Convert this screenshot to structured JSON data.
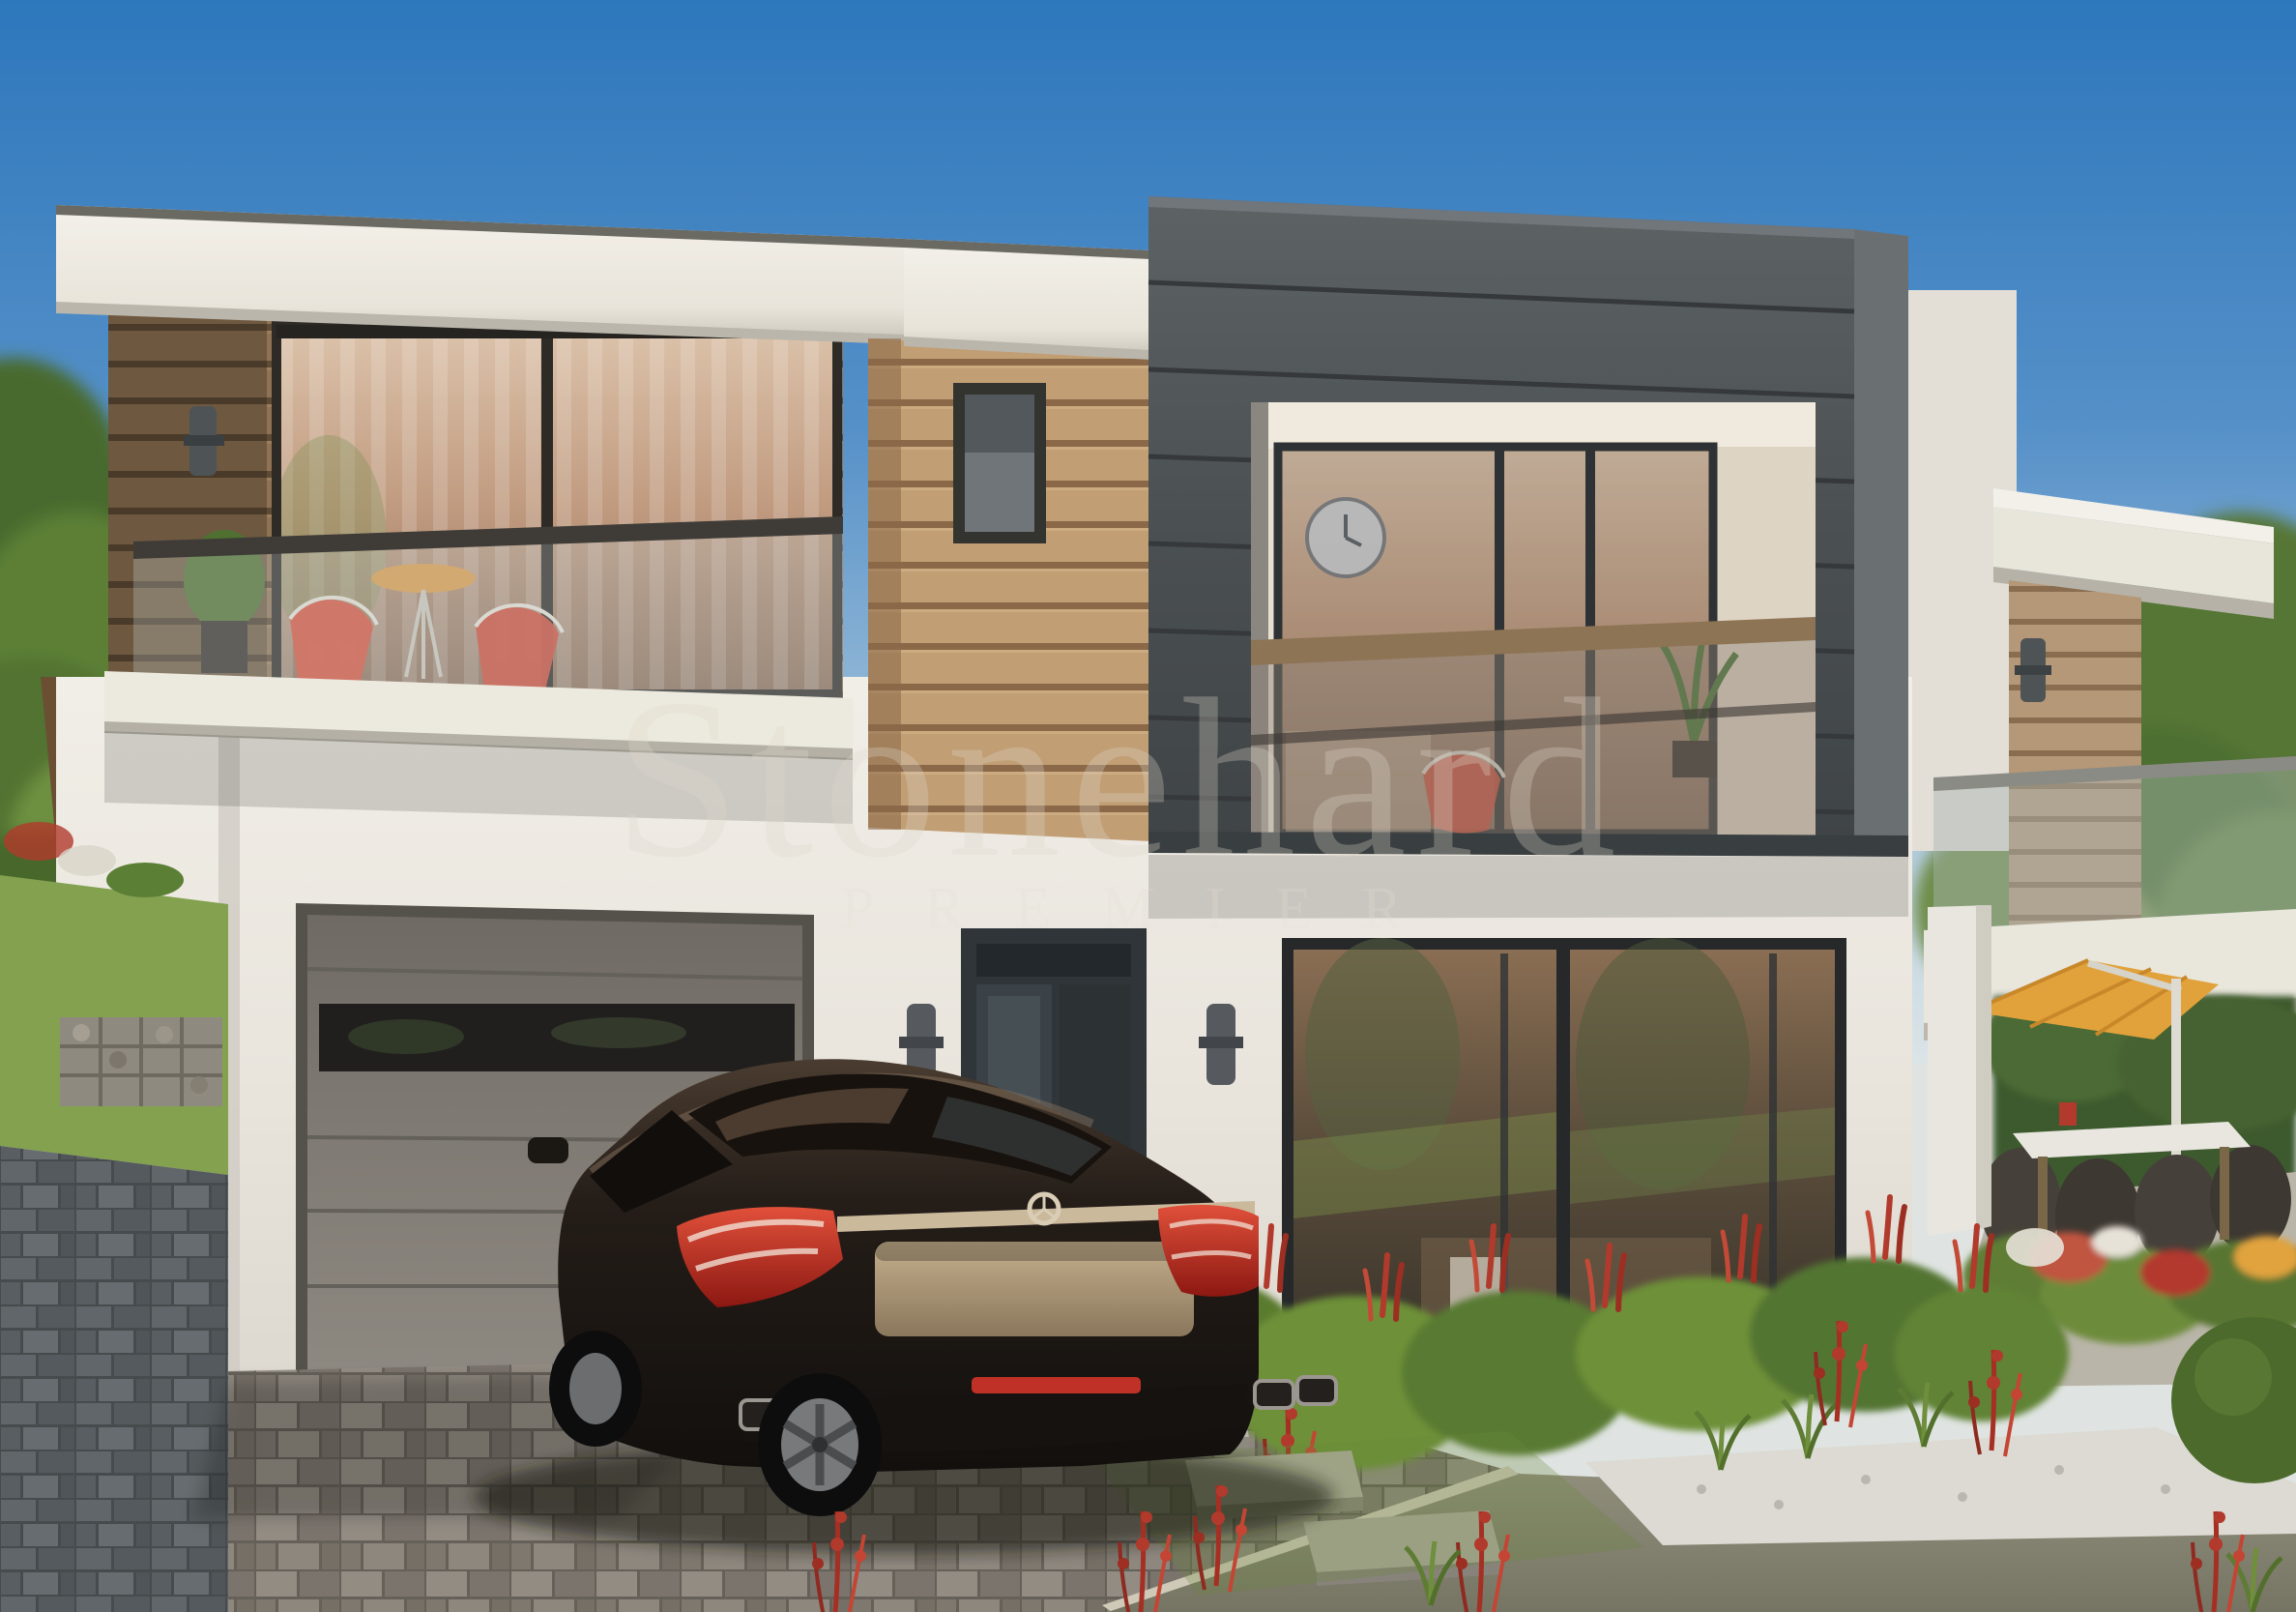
{
  "scene": {
    "type": "exterior-architectural-render",
    "subject": "modern two-storey flat-roof villa with wood and charcoal cladding, glass balconies, garage, dark sedan on paver driveway, landscaped garden and patio with cantilever umbrella",
    "time_of_day": "daytime, clear sky"
  },
  "watermark": {
    "brand": "Stonehard",
    "tagline": "PREMIER"
  },
  "palette": {
    "sky_top": "#2d77bc",
    "sky_horizon": "#d9e2e6",
    "facade_white": "#efece4",
    "wood_left": "#8f7253",
    "wood_center": "#c19e74",
    "wood_right": "#b59878",
    "charcoal_volume": "#4d5254",
    "glass_warm": "#c09a7f",
    "glass_dark": "#5e4f3d",
    "garage_door": "#7d7871",
    "umbrella": "#e2a23b",
    "car_body": "#1f1a15",
    "taillight_red": "#c0392b",
    "chrome": "#c7b597",
    "foliage_green": "#5c7f36",
    "salvia_red": "#b13a2c",
    "paver_beige": "#9d968c",
    "paver_blue": "#5d6366",
    "road": "#86846f",
    "gravel_white": "#dcdad2"
  }
}
